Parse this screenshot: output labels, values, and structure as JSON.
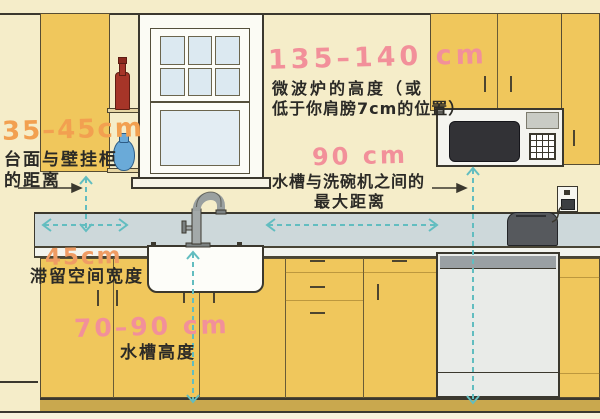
{
  "annotations": {
    "counter_to_wall_cabinet": {
      "value": "35–45cm",
      "line1": "台面与壁挂柜",
      "line2": "的距离"
    },
    "microwave_height": {
      "value": "135–140 cm",
      "line1": "微波炉的高度（或",
      "line2": "低于你肩膀7cm的位置）"
    },
    "sink_to_dishwasher": {
      "value": "90 cm",
      "line1": "水槽与洗碗机之间的",
      "line2": "最大距离"
    },
    "landing_space": {
      "value": "45cm",
      "label": "滞留空间宽度"
    },
    "sink_height": {
      "value": "70–90 cm",
      "label": "水槽高度"
    }
  },
  "colors": {
    "wall_cream": "#f5edc9",
    "cabinet_yellow": "#f0c75c",
    "counter_gray": "#cdd8da",
    "measure_teal": "#62bdc0",
    "value_pink": "#f2909a",
    "value_orange": "#f2a050",
    "label_black": "#2b2a26"
  }
}
